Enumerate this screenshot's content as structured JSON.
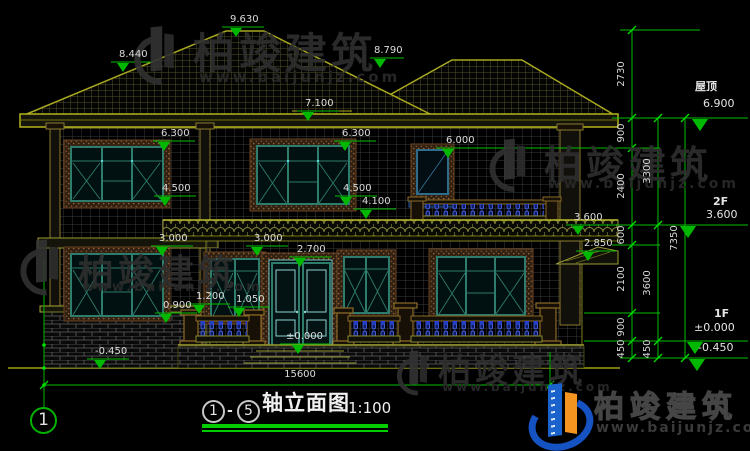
{
  "watermark": {
    "brand": "柏竣建筑",
    "site": "www.baijunjz.com"
  },
  "title": {
    "axis_start": "1",
    "axis_sep": "-",
    "axis_end": "5",
    "name": "轴立面图",
    "scale": "1:100"
  },
  "axis_bubble": "1",
  "bottom_dim": "15600",
  "level_markers": [
    "9.630",
    "8.440",
    "8.790",
    "7.100",
    "6.300",
    "6.300",
    "6.000",
    "4.500",
    "4.500",
    "4.100",
    "3.600",
    "3.000",
    "3.000",
    "2.850",
    "2.700",
    "1.200",
    "1.050",
    "0.900",
    "±0.000",
    "-0.450"
  ],
  "right_levels": [
    {
      "label": "屋顶",
      "value": "6.900"
    },
    {
      "label": "2F",
      "value": "3.600"
    },
    {
      "label": "1F",
      "value": "±0.000"
    },
    {
      "label": "",
      "value": "-0.450"
    }
  ],
  "chain_dims": [
    "2730",
    "900",
    "2400",
    "600",
    "2100",
    "900",
    "450",
    "3300",
    "3600",
    "450",
    "7350"
  ],
  "colors": {
    "dimension_green": "#00c000",
    "line_olive": "#a8a820",
    "window_teal": "#2e7c6c",
    "baluster_blue": "#4a66e0",
    "logo_blue": "#1a63cc",
    "logo_orange": "#f59520"
  }
}
